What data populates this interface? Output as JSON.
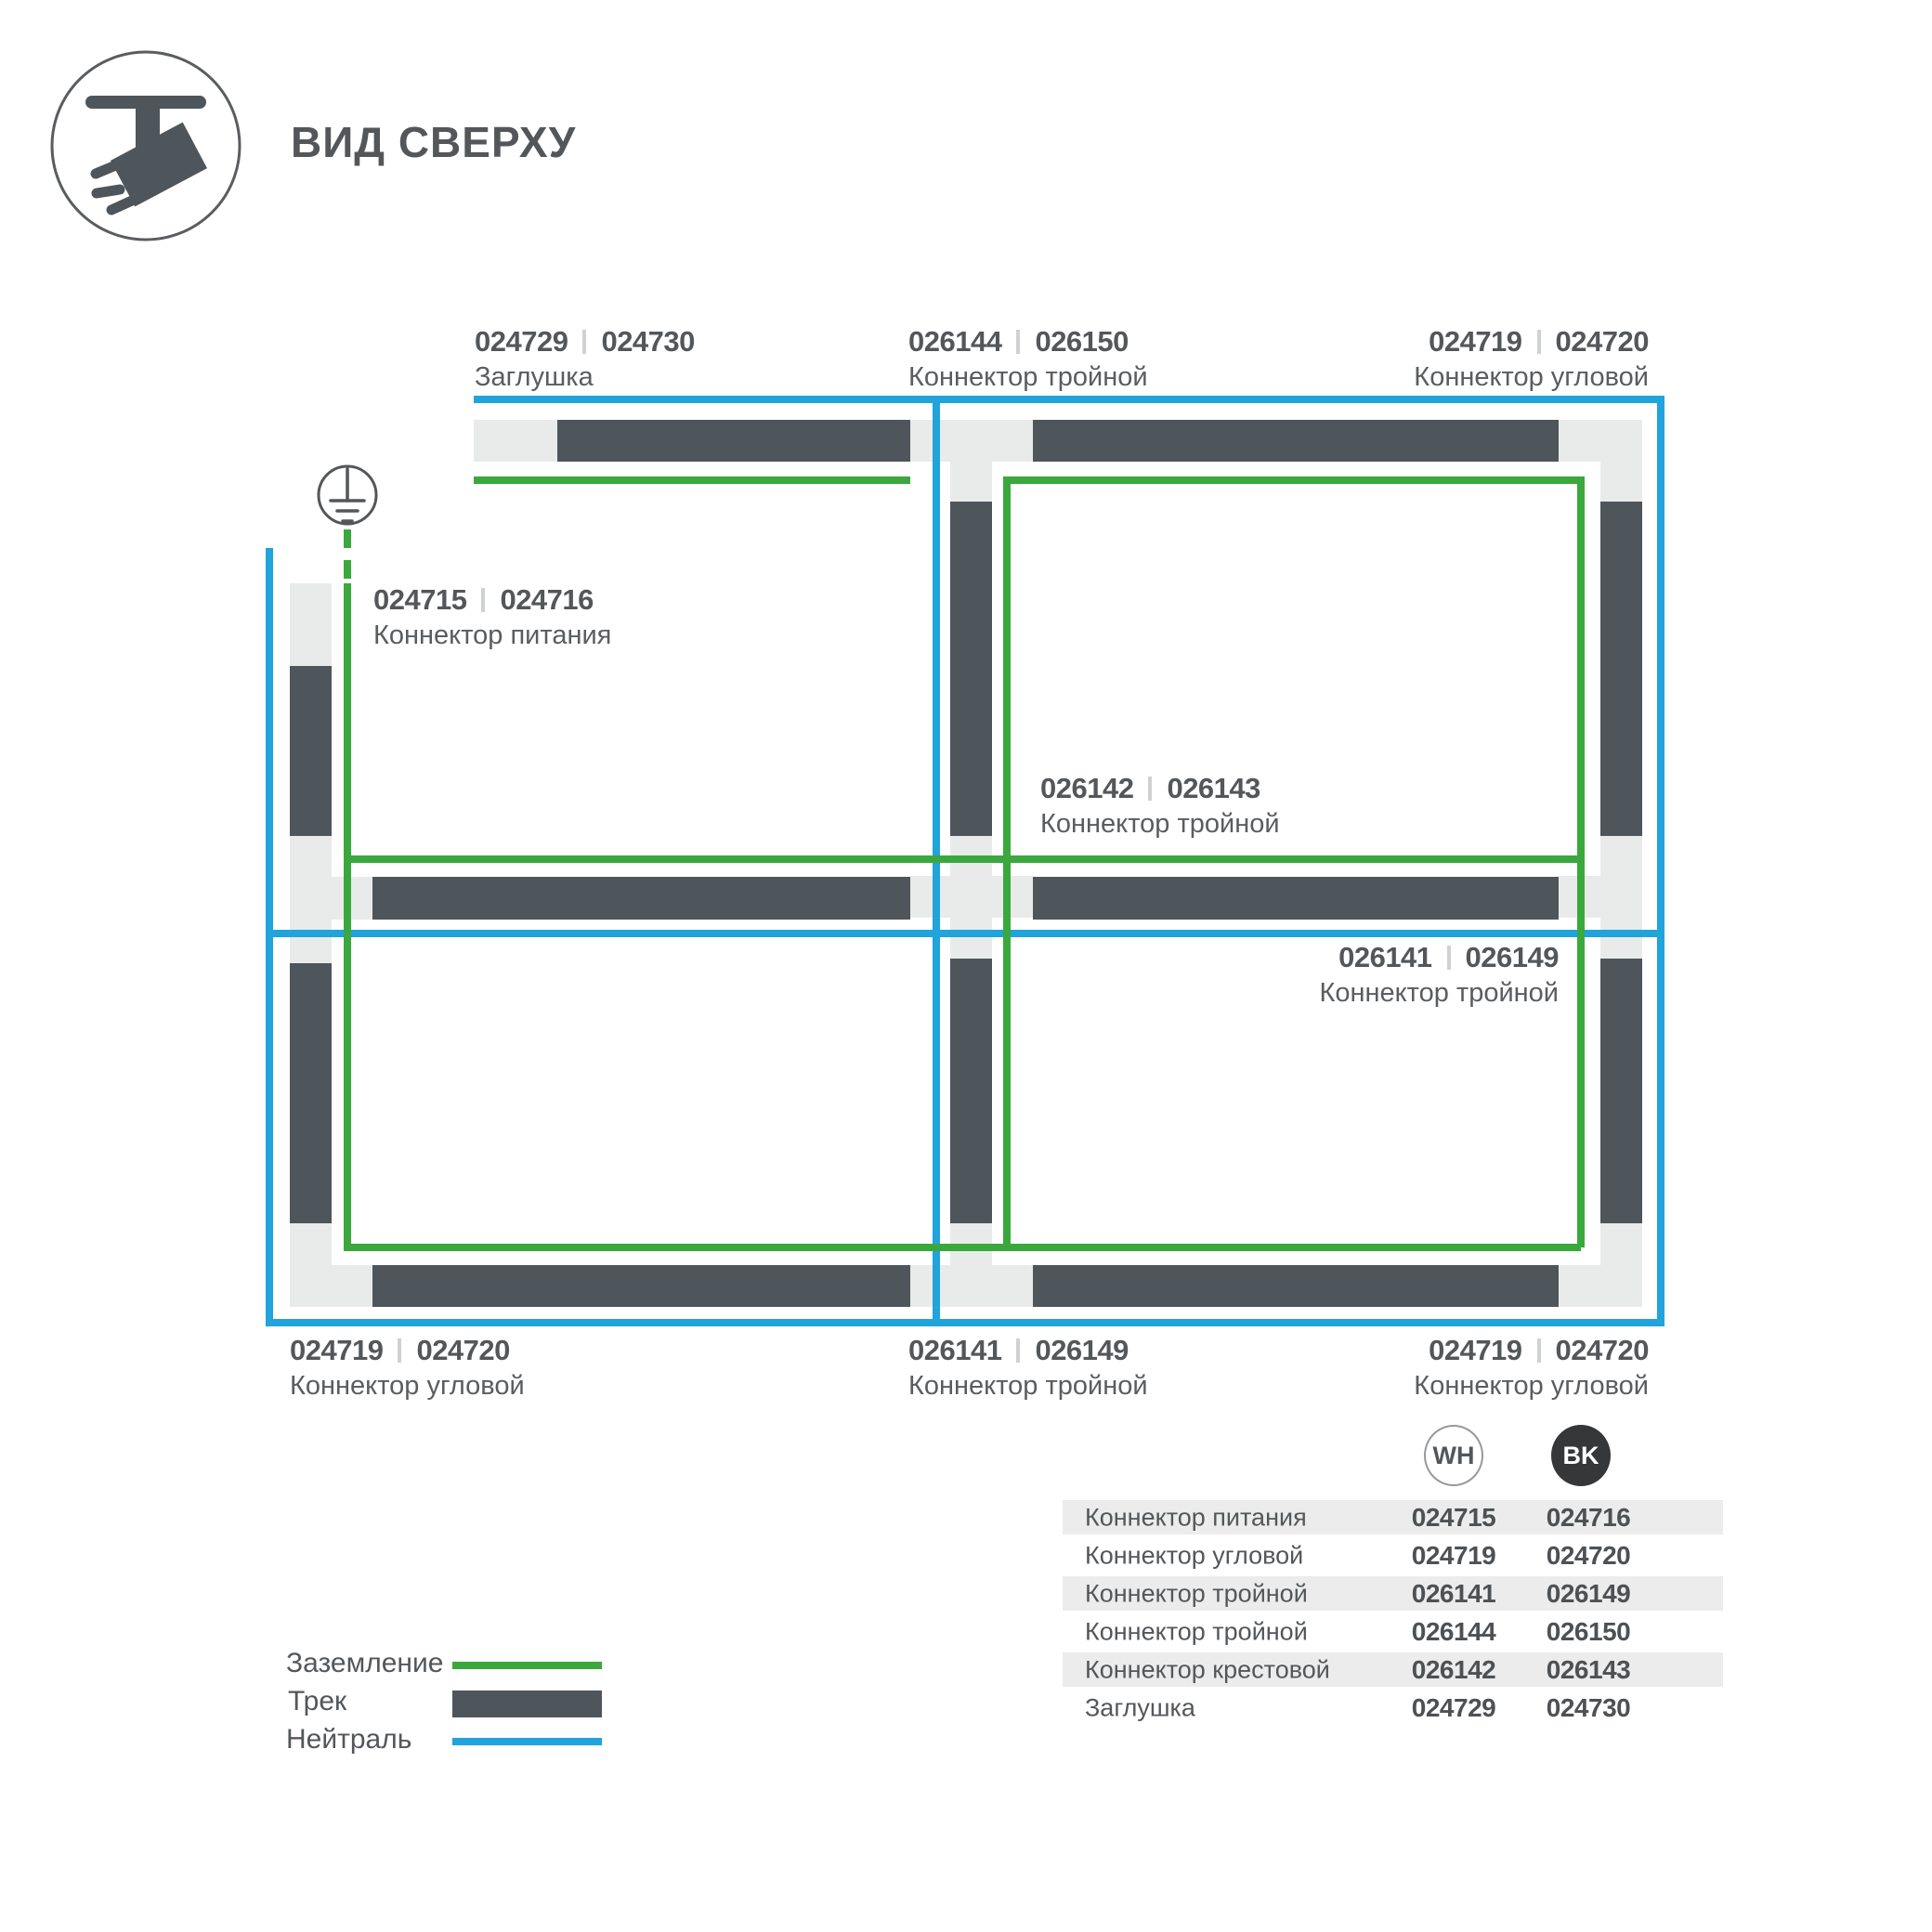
{
  "title": "ВИД СВЕРХУ",
  "colors": {
    "ground_green": "#3aa83c",
    "neutral_blue": "#21a3dc",
    "track_dark": "#4e565c",
    "connector_light": "#e9ebea",
    "text": "#54575a"
  },
  "diagram_labels": {
    "end_cap_top": {
      "wh": "024729",
      "bk": "024730",
      "name": "Заглушка"
    },
    "triple_top": {
      "wh": "026144",
      "bk": "026150",
      "name": "Коннектор тройной"
    },
    "corner_top_right": {
      "wh": "024719",
      "bk": "024720",
      "name": "Коннектор угловой"
    },
    "power": {
      "wh": "024715",
      "bk": "024716",
      "name": "Коннектор питания"
    },
    "cross_center": {
      "wh": "026142",
      "bk": "026143",
      "name": "Коннектор тройной"
    },
    "triple_mid_right": {
      "wh": "026141",
      "bk": "026149",
      "name": "Коннектор тройной"
    },
    "corner_bottom_left": {
      "wh": "024719",
      "bk": "024720",
      "name": "Коннектор угловой"
    },
    "triple_bottom": {
      "wh": "026141",
      "bk": "026149",
      "name": "Коннектор тройной"
    },
    "corner_bottom_right": {
      "wh": "024719",
      "bk": "024720",
      "name": "Коннектор угловой"
    }
  },
  "legend": {
    "ground": "Заземление",
    "track": "Трек",
    "neutral": "Нейтраль"
  },
  "table": {
    "col_wh": "WH",
    "col_bk": "BK",
    "rows": [
      {
        "name": "Коннектор питания",
        "wh": "024715",
        "bk": "024716"
      },
      {
        "name": "Коннектор угловой",
        "wh": "024719",
        "bk": "024720"
      },
      {
        "name": "Коннектор тройной",
        "wh": "026141",
        "bk": "026149"
      },
      {
        "name": "Коннектор тройной",
        "wh": "026144",
        "bk": "026150"
      },
      {
        "name": "Коннектор крестовой",
        "wh": "026142",
        "bk": "026143"
      },
      {
        "name": "Заглушка",
        "wh": "024729",
        "bk": "024730"
      }
    ]
  }
}
